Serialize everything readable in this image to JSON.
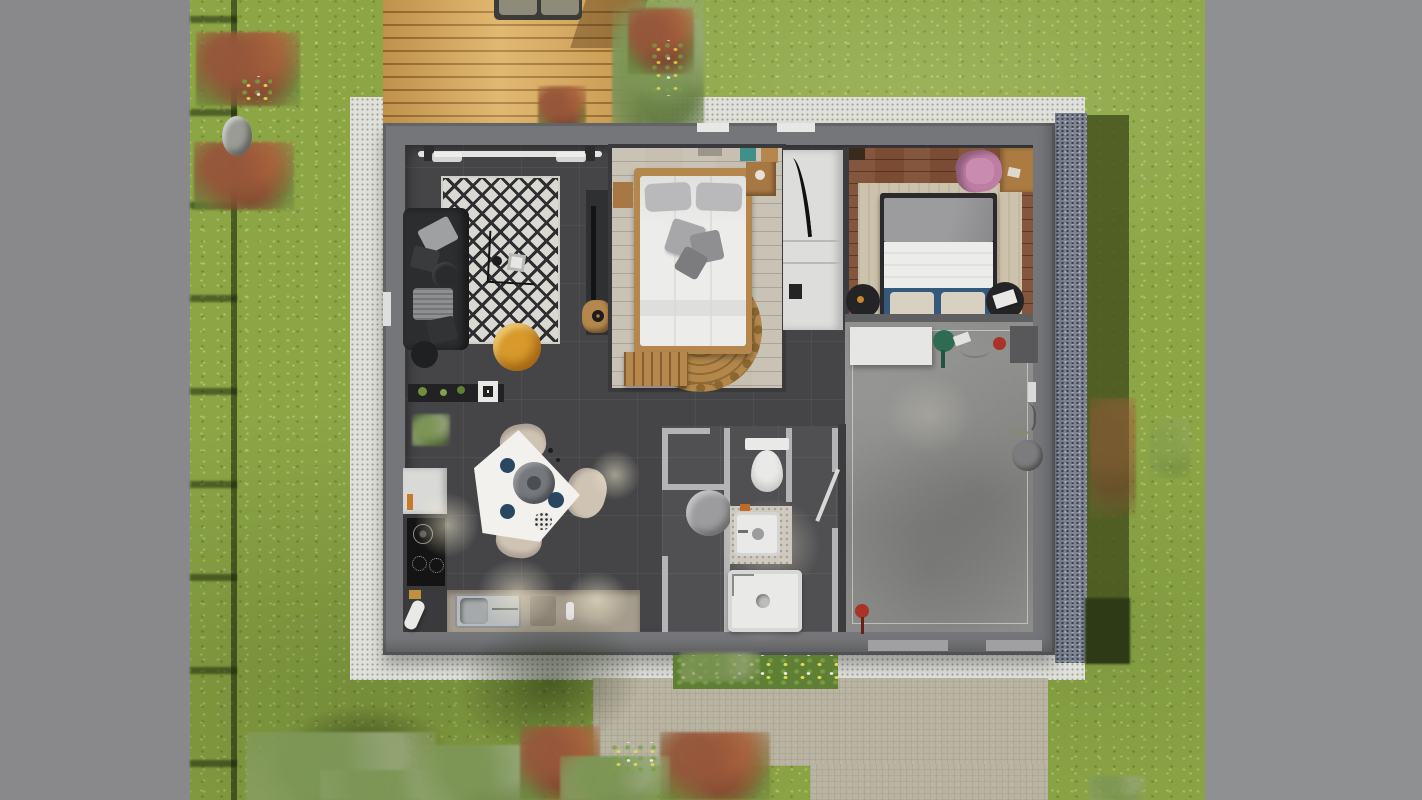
{
  "scene": {
    "kind": "architectural-3d-floor-plan-render",
    "view": "top-down",
    "rooms": [
      "living-room",
      "kitchen-dining",
      "bedroom-1",
      "hallway",
      "bedroom-2",
      "bathroom-wc",
      "garage"
    ],
    "garden_features": [
      "lawn",
      "wood-deck",
      "outdoor-sofa",
      "gravel-apron",
      "stone-path",
      "flower-bed",
      "shrubs",
      "trees",
      "fence",
      "rock"
    ]
  },
  "palette": {
    "lawn": "#8ca646",
    "bandLeft": "#89898c",
    "bandRight": "#8f9092",
    "apron": "#e0e1db",
    "gravel": "#7d8492",
    "hedge": "#46521f",
    "deck": "#d8a95d",
    "deckSofa": "#3b3b37",
    "deckCushion": "#8e8b7b",
    "path": "#b9b4a1",
    "stone": "#9b9b95",
    "wall": "#757679",
    "wallDark": "#5e5f61",
    "floorDark": "#454548",
    "floorBath": "#505053",
    "bathWall": "#b4b4b6",
    "bedroom1Floor": "#c6bfb2",
    "bedroom2Floor": "#7b4b33",
    "garageFloor": "#8e8e8c",
    "rugWhite": "#d9d8d3",
    "sofa": "#2c2d2f",
    "poufYellow": "#d79a2b",
    "poufBlack": "#1f2022",
    "woodFrame": "#b5874c",
    "jute": "#b3874a",
    "bedWhite": "#ececea",
    "pillowGray": "#b9b9bb",
    "blanketGray": "#9c9c9e",
    "navy": "#34597a",
    "rugBeige": "#cdc2ab",
    "nightBlack": "#242426",
    "deskWood": "#ab7b42",
    "chairPink": "#bd7da4",
    "counterWhite": "#e6e6e4",
    "matDark": "#58585a",
    "wateringCan": "#2f6b52",
    "red": "#a83326",
    "fixtureWhite": "#e9e9e7",
    "tableGray": "#9c9c9e",
    "steel": "#b8bbbd",
    "cooktop": "#141414",
    "counterBeige": "#a59c8d",
    "teal": "#3f9187",
    "wardrobe": "#dddddc",
    "flowerbedGreen": "#5f7f35",
    "chairBeige": "#cfc3b4",
    "shelfBlack": "#222224"
  },
  "inventory": {
    "living_room": [
      "corner-sofa",
      "throw-pillows",
      "coffee-table",
      "geometric-rug",
      "yellow-pouf",
      "black-pouf",
      "tv-sideboard",
      "wooden-stool",
      "curtain-window",
      "plant-shelf",
      "potted-plant"
    ],
    "kitchen": [
      "l-shaped-counter",
      "fridge-cabinet",
      "induction-hob",
      "stainless-sink",
      "triangular-dining-table",
      "lazy-susan",
      "dining-chair",
      "dining-chair",
      "dining-chair",
      "navy-plates"
    ],
    "bedroom_1": [
      "double-bed",
      "gray-pillows",
      "round-jute-rug",
      "foot-bench",
      "nightstand",
      "nightstand",
      "teal-wall-art"
    ],
    "hallway": [
      "wardrobe",
      "tall-mirror"
    ],
    "bedroom_2": [
      "double-bed",
      "blue-headboard",
      "patterned-pillows",
      "round-nightstand",
      "round-nightstand",
      "area-rug",
      "desk",
      "pink-chair"
    ],
    "bathroom": [
      "toilet",
      "washbasin",
      "shower",
      "round-side-table",
      "door-leaf"
    ],
    "garage": [
      "worktop",
      "watering-can",
      "doormat",
      "bucket",
      "red-valve",
      "floor-mat"
    ]
  }
}
